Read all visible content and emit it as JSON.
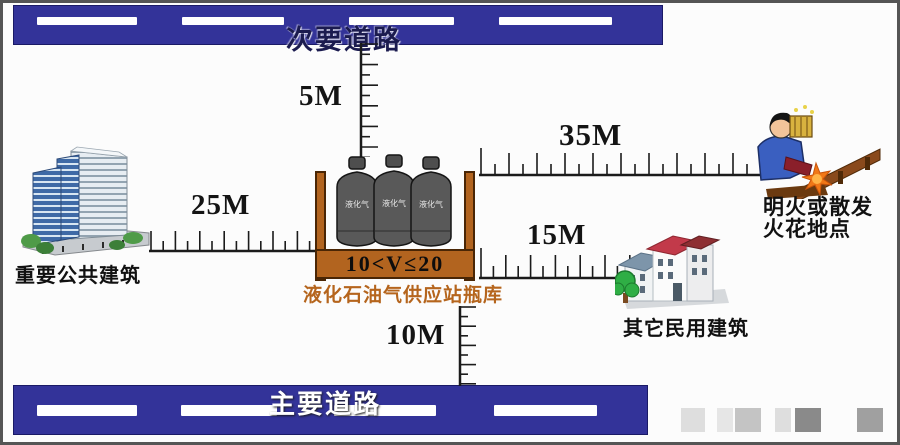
{
  "diagram_title": "液化石油气供应站瓶库安全距离示意图",
  "roads": {
    "secondary": "次要道路",
    "main": "主要道路"
  },
  "station": {
    "volume_range": "10<V≤20",
    "caption": "液化石油气供应站瓶库",
    "cylinder_text": "液化气",
    "cylinder_count": 3
  },
  "buildings": {
    "public": "重要公共建筑",
    "civil": "其它民用建筑"
  },
  "flame_spot": {
    "line1": "明火或散发",
    "line2": "火花地点"
  },
  "distances": {
    "to_secondary_road": "5M",
    "to_public_building": "25M",
    "to_open_flame": "35M",
    "to_civil_building": "15M",
    "to_main_road": "10M"
  },
  "relations": [
    {
      "from": "液化石油气供应站瓶库",
      "to": "次要道路",
      "distance": "5M"
    },
    {
      "from": "液化石油气供应站瓶库",
      "to": "重要公共建筑",
      "distance": "25M"
    },
    {
      "from": "液化石油气供应站瓶库",
      "to": "明火或散发火花地点",
      "distance": "35M"
    },
    {
      "from": "液化石油气供应站瓶库",
      "to": "其它民用建筑",
      "distance": "15M"
    },
    {
      "from": "液化石油气供应站瓶库",
      "to": "主要道路",
      "distance": "10M"
    }
  ],
  "colors": {
    "road_blue": "#333399",
    "container_orange": "#b2641f",
    "caption_orange": "#b5651d",
    "cylinder_gray": "#595959",
    "spark_orange": "#f07818"
  }
}
